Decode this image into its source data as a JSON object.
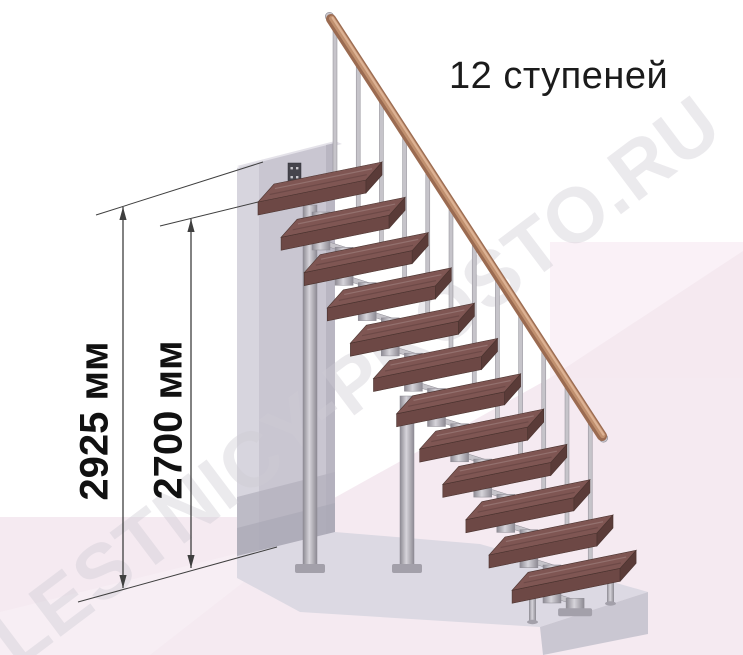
{
  "title": "12 ступеней",
  "watermark": "LESTNICY-PROSTO.RU",
  "dimensions": [
    {
      "label": "2925 мм",
      "value_mm": 2925
    },
    {
      "label": "2700 мм",
      "value_mm": 2700
    }
  ],
  "staircase": {
    "steps": 12,
    "balusters": 12
  },
  "palette": {
    "tread_top": "#7f5653",
    "tread_front": "#6d4845",
    "tread_side": "#5a3b38",
    "tread_stroke": "#4a332f",
    "metal_light": "#d6d4da",
    "metal_mid": "#c6c4ca",
    "metal_dark": "#8d8a93",
    "plate_gray": "#a3a0aa",
    "wall_front": "#c9c6d1",
    "wall_left": "#d7d5de",
    "wall_top": "#e4e2e9",
    "wall_edge": "#b9b6c2",
    "wall_shadow": "#b2afbc",
    "wall_shadow_deep": "#a9a6b4",
    "slab_top": "#dcd9e3",
    "slab_front": "#cac7d2",
    "floor_pink": "#f5eaf1",
    "wall_pink_light": "#faf1f7",
    "wall_pink_deep": "#f3e7ef",
    "pink_lighter": "#f8eff5",
    "rail_dark": "#9b6b51",
    "rail_mid": "#c0906f",
    "rail_light": "#ddb294",
    "rail_cap": "#cbc9cf",
    "bracket": "#45444c",
    "dim_line": "#3f3f3f",
    "watermark_color": "#cfccd4",
    "title_color": "#1b1b1b"
  }
}
